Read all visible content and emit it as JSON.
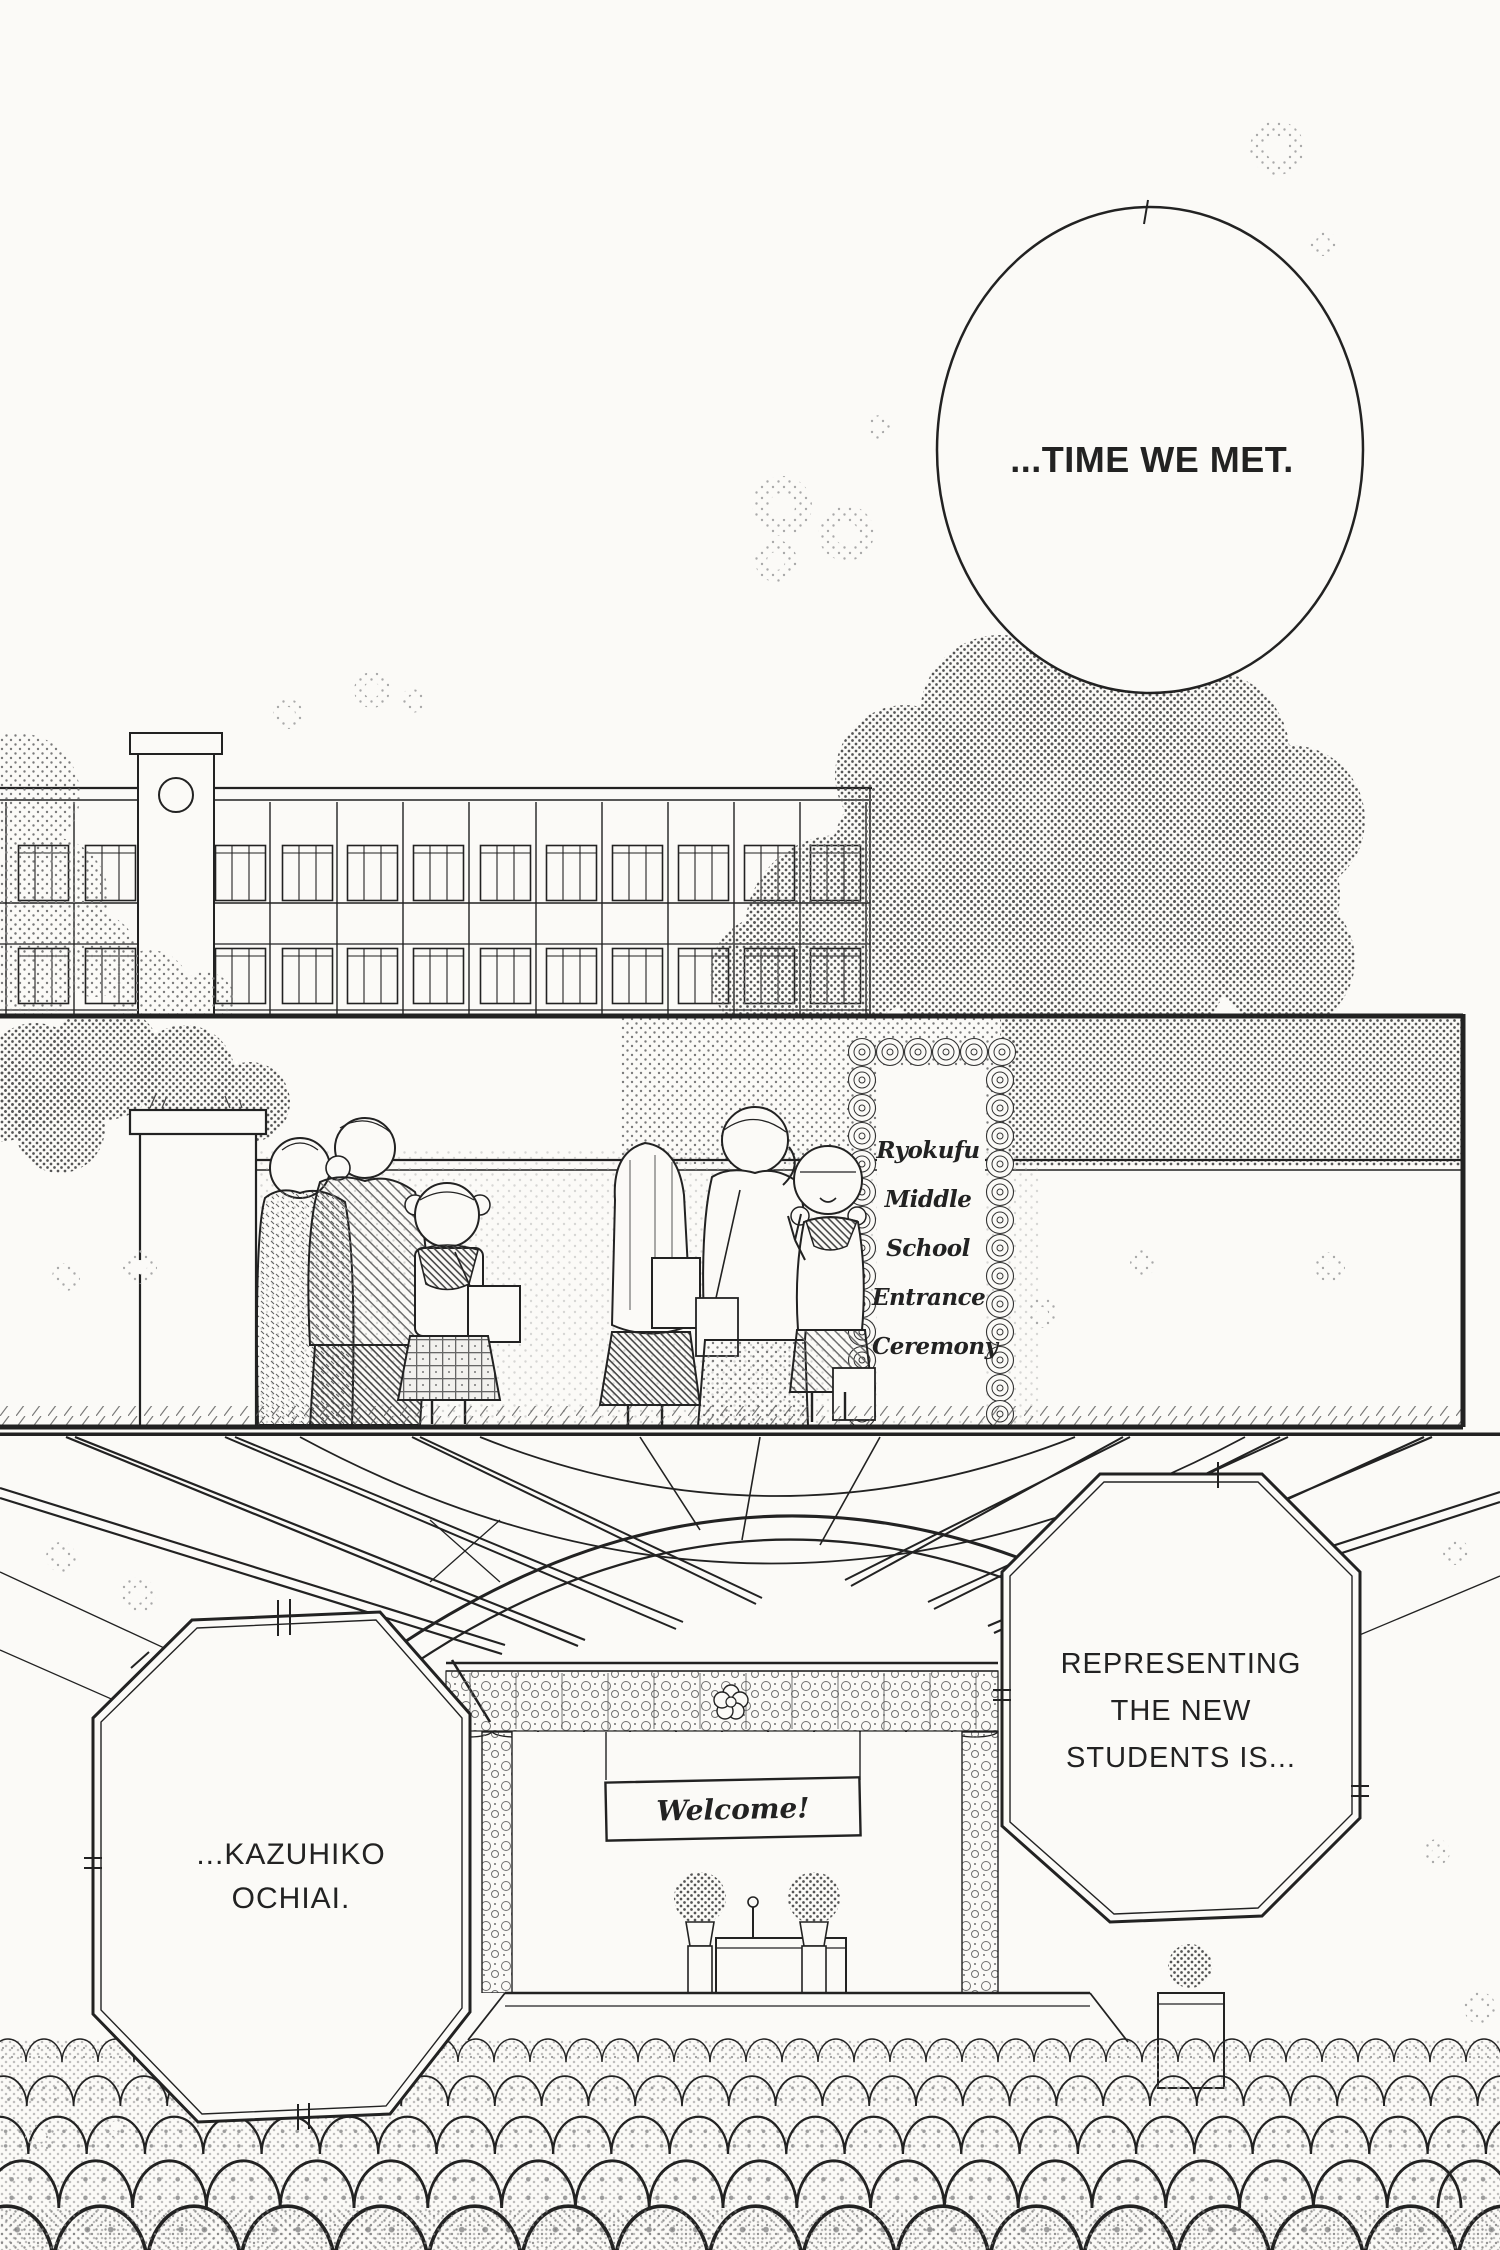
{
  "palette": {
    "paper": "#fbfaf7",
    "ink": "#222222"
  },
  "dialogue": {
    "time_bubble": "...TIME WE MET.",
    "representing_lines": [
      "REPRESENTING",
      "THE NEW",
      "STUDENTS IS..."
    ],
    "kazuhiko_lines": [
      "...KAZUHIKO",
      "OCHIAI."
    ]
  },
  "entrance_sign": {
    "lines": [
      "Ryokufu",
      "Middle",
      "School",
      "Entrance",
      "Ceremony"
    ]
  },
  "stage": {
    "banner": "Welcome!"
  }
}
